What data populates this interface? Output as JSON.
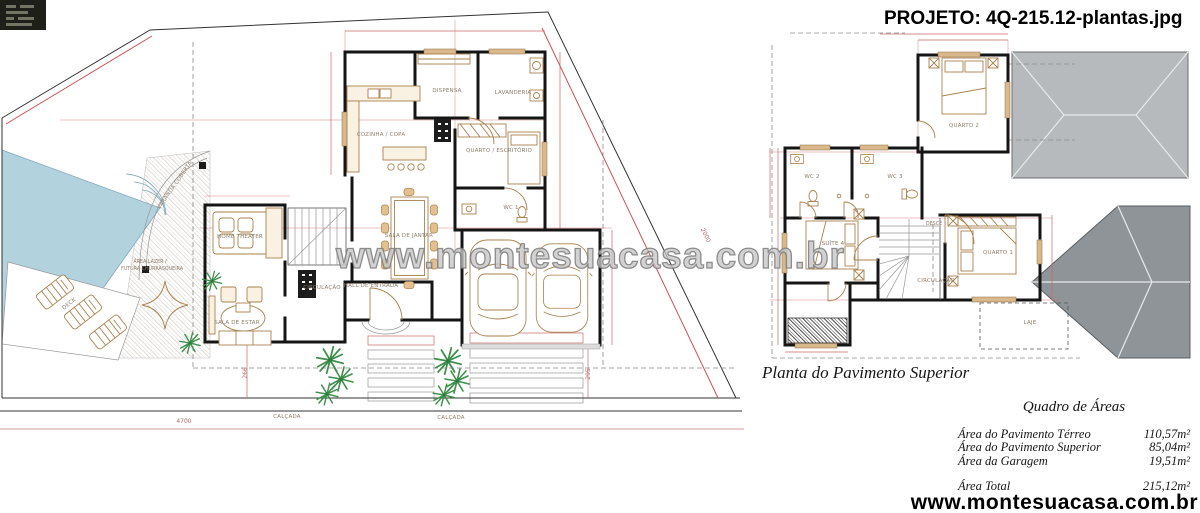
{
  "meta": {
    "project_title": "PROJETO: 4Q-215.12-plantas.jpg"
  },
  "watermarks": {
    "center": "www.montesuacasa.com.br",
    "bottom_right": "www.montesuacasa.com.br"
  },
  "ground_floor": {
    "rooms": {
      "dispensa": "DISPENSA",
      "lavanderia": "LAVANDERIA",
      "cozinha_copa": "COZINHA / COPA",
      "quarto_escritorio": "QUARTO / ESCRITÓRIO",
      "wc1": "WC 1",
      "sala_jantar": "SALA DE JANTAR",
      "home_theater": "HOME THEATER",
      "sala_estar": "SALA DE ESTAR",
      "circulacao": "CIRCULAÇÃO",
      "hall_entrada": "HALL DE ENTRADA",
      "varanda_coberta": "VARANDA COBERTA",
      "deck": "DECK",
      "area_lazer_line1": "ÁREA LAZER /",
      "area_lazer_line2": "FUTURA CHURRASQUEIRA",
      "calcada_1": "CALÇADA",
      "calcada_2": "CALÇADA"
    },
    "dimensions": {
      "left_side": "266",
      "right_side": "295",
      "boundary": "2000",
      "frontage": "4700"
    }
  },
  "upper_floor": {
    "caption": "Planta do Pavimento Superior",
    "rooms": {
      "quarto_2": "QUARTO 2",
      "wc2": "WC 2",
      "wc3": "WC 3",
      "suite": "SUÍTE 4",
      "quarto_1": "QUARTO 1",
      "desce": "DESCE",
      "circulacao": "CIRCULAÇÃO",
      "laje": "LAJE"
    }
  },
  "areas_table": {
    "title": "Quadro de Áreas",
    "rows": [
      {
        "label": "Área do Pavimento Térreo",
        "value": "110,57m²"
      },
      {
        "label": "Área do Pavimento Superior",
        "value": "85,04m²"
      },
      {
        "label": "Área da Garagem",
        "value": "19,51m²"
      }
    ],
    "total": {
      "label": "Área Total",
      "value": "215,12m²"
    }
  },
  "colors": {
    "wall": "#151515",
    "dimension_red": "#c96a6a",
    "pool_blue": "#b2d2de",
    "plant_green": "#3e8f4c",
    "furniture_tan": "#a9824f",
    "roof_light": "#b6babc",
    "roof_dark": "#8e9497"
  }
}
